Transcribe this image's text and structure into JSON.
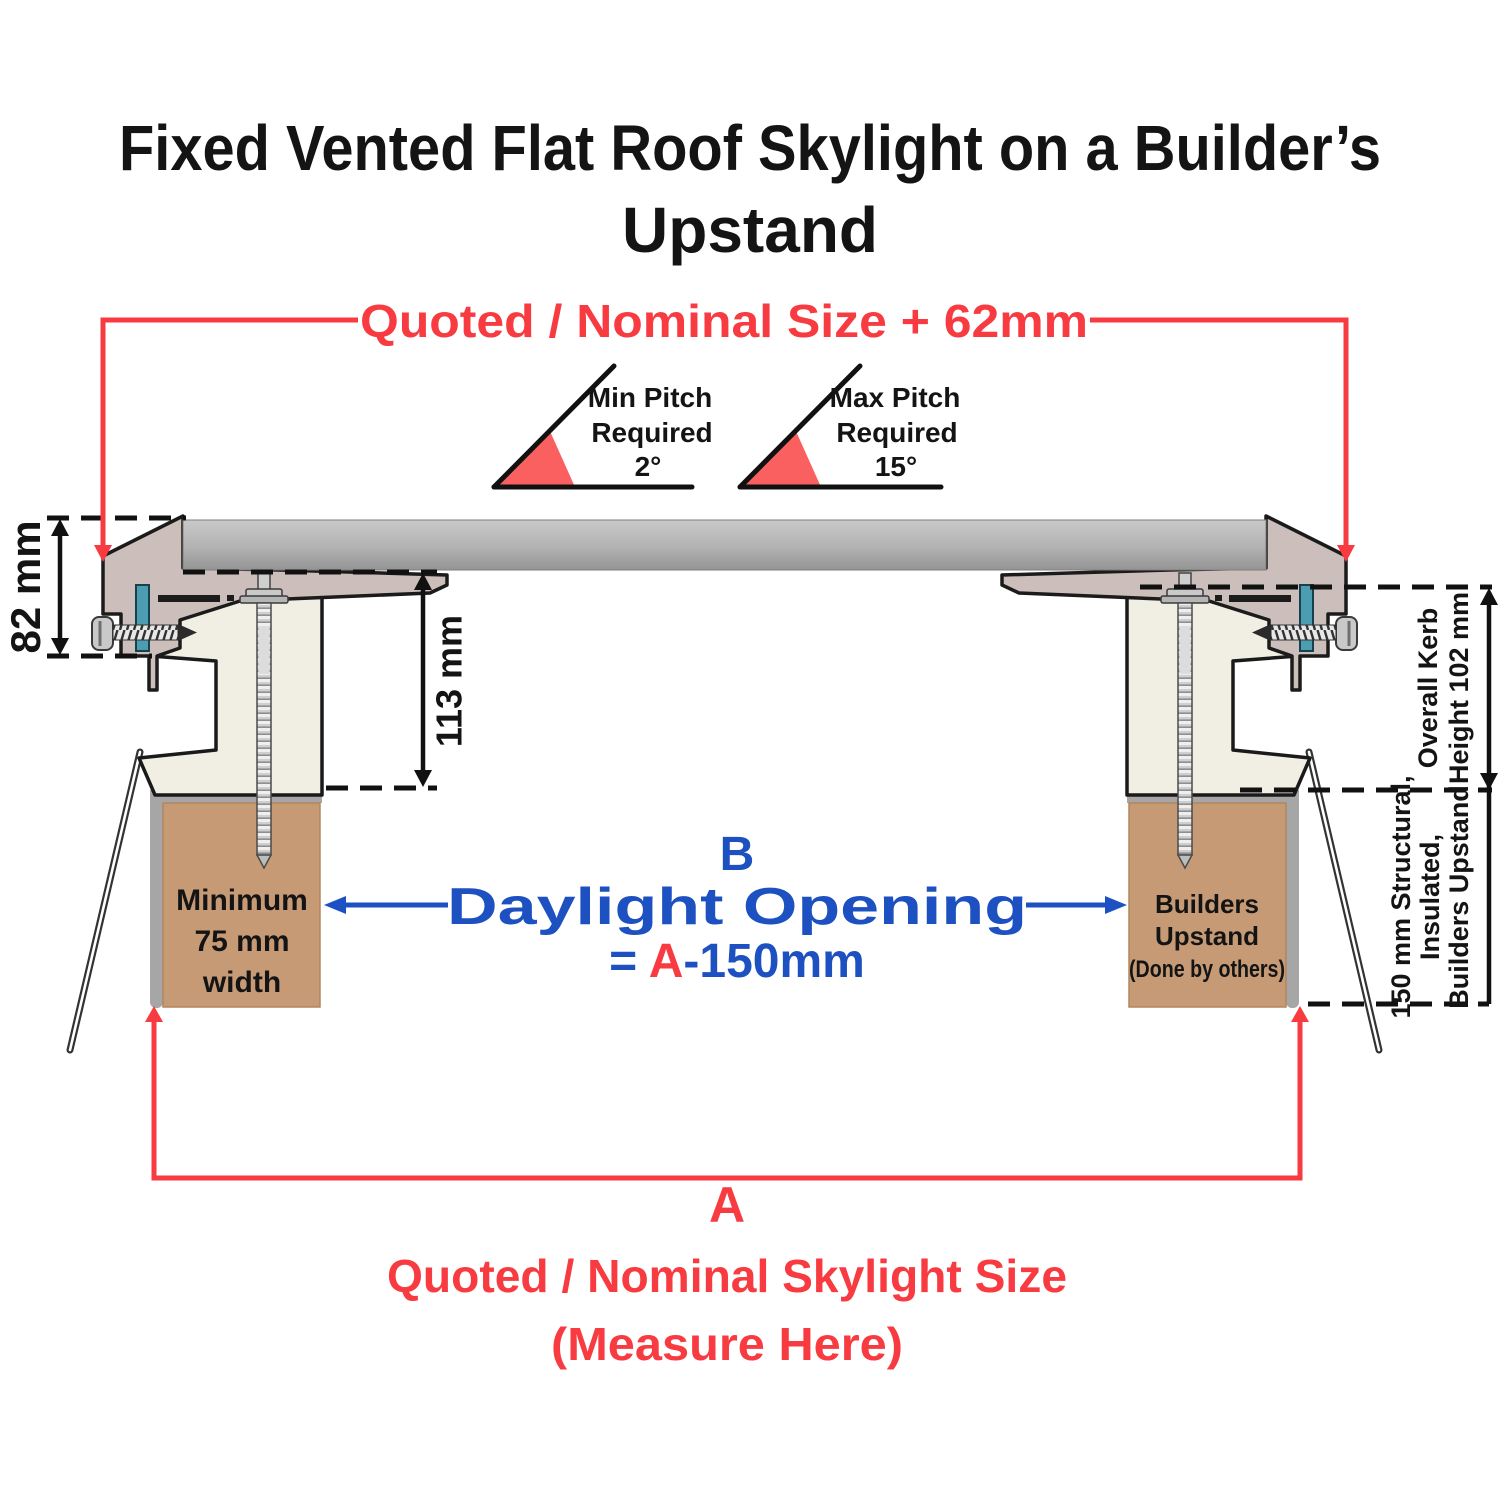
{
  "title": {
    "line1": "Fixed Vented Flat Roof Skylight on a Builder’s",
    "line2": "Upstand"
  },
  "top_dimension": {
    "label": "Quoted / Nominal Size + 62mm"
  },
  "pitch": {
    "min": {
      "line1": "Min Pitch",
      "line2": "Required",
      "value": "2°"
    },
    "max": {
      "line1": "Max Pitch",
      "line2": "Required",
      "value": "15°"
    }
  },
  "dimensions": {
    "frame_height": "82 mm",
    "kerb_inner_height": "113 mm",
    "overall_kerb_line1": "Overall Kerb",
    "overall_kerb_line2": "Height 102 mm",
    "upstand_spec_line1": "150 mm Structural,",
    "upstand_spec_line2": "Insulated,",
    "upstand_spec_line3": "Builders Upstand"
  },
  "daylight": {
    "label": "B",
    "name": "Daylight Opening",
    "formula_prefix": "= ",
    "formula_a": "A",
    "formula_suffix": "-150mm"
  },
  "left_upstand": {
    "line1": "Minimum",
    "line2": "75 mm",
    "line3": "width"
  },
  "right_upstand": {
    "line1": "Builders",
    "line2": "Upstand",
    "line3": "(Done by others)"
  },
  "bottom_dimension": {
    "label": "A",
    "line1": "Quoted / Nominal Skylight Size",
    "line2": "(Measure Here)"
  },
  "colors": {
    "red": "#f73b41",
    "blue": "#1d50c0",
    "black": "#141414",
    "frame_mauve": "#ccbfbb",
    "kerb_cream": "#f1efe4",
    "upstand_brown": "#c79a76",
    "membrane_gray": "#a6a6a6",
    "gasket_teal": "#4d9db2",
    "wedge_red": "#f9605f",
    "glass_gray": "#b0b0b0"
  }
}
